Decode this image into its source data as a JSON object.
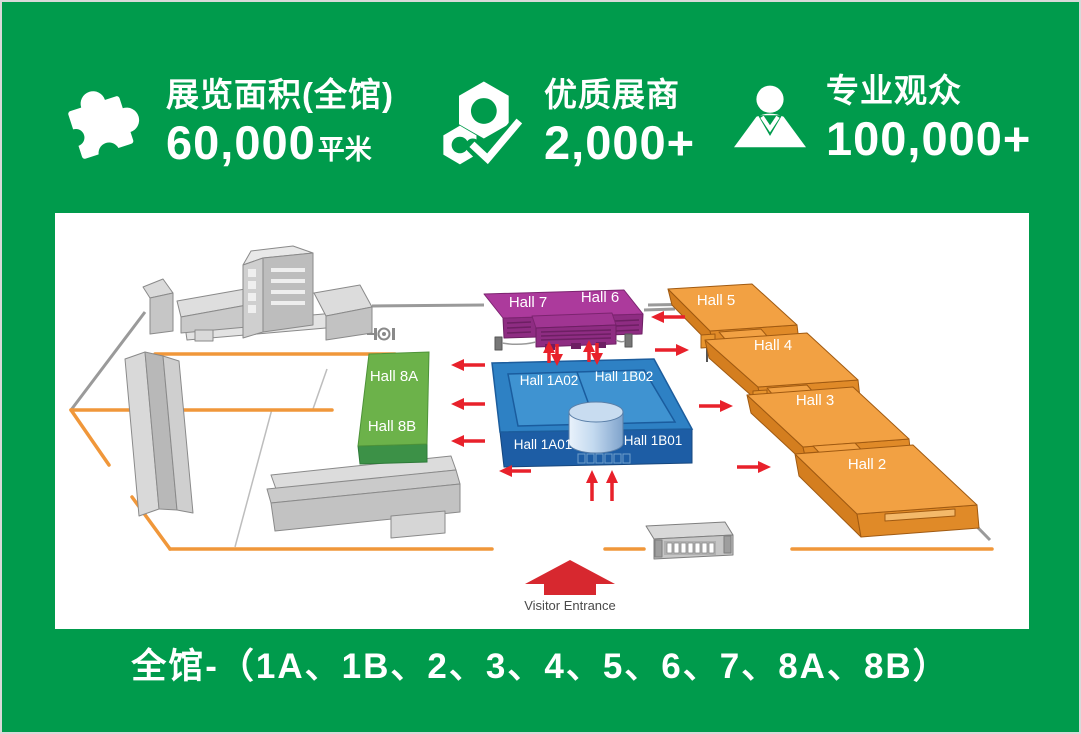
{
  "colors": {
    "background_green": "#009B4C",
    "panel_white": "#FFFFFF",
    "hall_blue_top": "#2E81C4",
    "hall_blue_front": "#1D5DA5",
    "hall_purple_top": "#AC3A9C",
    "hall_purple_front": "#8E2C82",
    "hall_orange_top": "#F2A143",
    "hall_orange_front": "#E08A28",
    "hall_green_top": "#6CB24A",
    "hall_green_front": "#3C9147",
    "arrow_red": "#E8212B",
    "entrance_arrow_red": "#D7282F",
    "boundary_orange": "#F0973A",
    "road_gray": "#9A9A9A",
    "building_gray": "#D6D6D6"
  },
  "stats": [
    {
      "icon": "puzzle-icon",
      "title": "展览面积(全馆)",
      "value": "60,000",
      "unit": "平米"
    },
    {
      "icon": "hexnut-check-icon",
      "title": "优质展商",
      "value": "2,000+",
      "unit": ""
    },
    {
      "icon": "visitor-person-icon",
      "title": "专业观众",
      "value": "100,000+",
      "unit": ""
    }
  ],
  "map": {
    "halls": {
      "hall7": "Hall 7",
      "hall6": "Hall 6",
      "hall8a": "Hall 8A",
      "hall8b": "Hall 8B",
      "hall1a02": "Hall 1A02",
      "hall1b02": "Hall 1B02",
      "hall1a01": "Hall 1A01",
      "hall1b01": "Hall 1B01",
      "hall5": "Hall 5",
      "hall4": "Hall 4",
      "hall3": "Hall 3",
      "hall2": "Hall 2"
    },
    "entrance_label": "Visitor Entrance"
  },
  "footer": {
    "text": "全馆-（1A、1B、2、3、4、5、6、7、8A、8B）"
  }
}
